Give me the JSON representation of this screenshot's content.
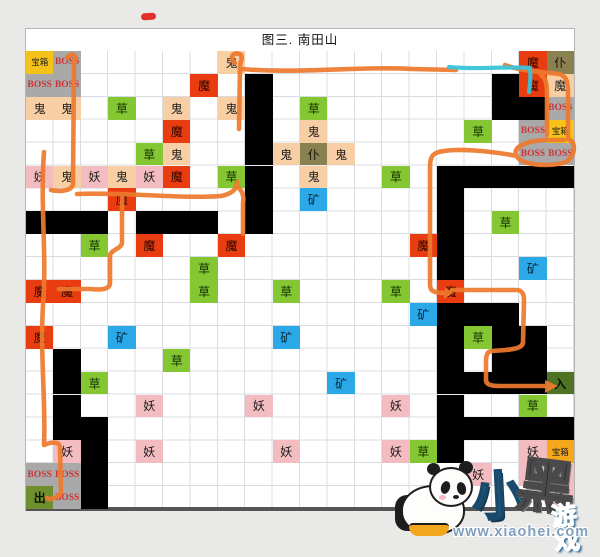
{
  "page": {
    "title": "图三. 南田山"
  },
  "palette": {
    "chest": "#f6c21a",
    "chest2": "#f5a81c",
    "boss": "#a9a9a9",
    "bossText": "#cf3434",
    "ghost": "#f8cfa4",
    "demon": "#f3bcc0",
    "devil": "#e93c10",
    "grass": "#85c733",
    "ore": "#2aa8e8",
    "servant": "#8a8150",
    "exit": "#6f8f2f",
    "entrance": "#4f7324",
    "wall": "#000000",
    "routeOrange": "#ee7a2e",
    "routeCyan": "#3cc3d8",
    "redmark": "#e03027"
  },
  "map": {
    "cols": 20,
    "rows": 20,
    "kind_meanings": {
      "chest": "宝箱 treasure chest",
      "boss": "BOSS",
      "ghost": "鬼 ghost",
      "demon": "妖 demon",
      "devil": "魔 devil",
      "grass": "草 herb",
      "ore": "矿 ore",
      "servant": "仆 servant",
      "exit": "出 exit",
      "entrance": "入 entrance",
      "wall": "black block"
    },
    "cells": [
      {
        "r": 1,
        "c": 1,
        "t": "宝箱",
        "k": "chest"
      },
      {
        "r": 1,
        "c": 2,
        "t": "BOSS",
        "k": "boss"
      },
      {
        "r": 1,
        "c": 8,
        "t": "鬼",
        "k": "ghost"
      },
      {
        "r": 1,
        "c": 19,
        "t": "魔",
        "k": "devil"
      },
      {
        "r": 1,
        "c": 20,
        "t": "仆",
        "k": "servant"
      },
      {
        "r": 2,
        "c": 1,
        "t": "BOSS",
        "k": "boss"
      },
      {
        "r": 2,
        "c": 2,
        "t": "BOSS",
        "k": "boss"
      },
      {
        "r": 2,
        "c": 7,
        "t": "魔",
        "k": "devil"
      },
      {
        "r": 2,
        "c": 19,
        "t": "魔",
        "k": "devil"
      },
      {
        "r": 2,
        "c": 20,
        "t": "魔",
        "k": "ghost"
      },
      {
        "r": 3,
        "c": 1,
        "t": "鬼",
        "k": "ghost"
      },
      {
        "r": 3,
        "c": 2,
        "t": "鬼",
        "k": "ghost"
      },
      {
        "r": 3,
        "c": 4,
        "t": "草",
        "k": "grass"
      },
      {
        "r": 3,
        "c": 6,
        "t": "鬼",
        "k": "ghost"
      },
      {
        "r": 3,
        "c": 8,
        "t": "鬼",
        "k": "ghost"
      },
      {
        "r": 3,
        "c": 11,
        "t": "草",
        "k": "grass"
      },
      {
        "r": 3,
        "c": 20,
        "t": "BOSS",
        "k": "boss"
      },
      {
        "r": 4,
        "c": 6,
        "t": "魔",
        "k": "devil"
      },
      {
        "r": 4,
        "c": 11,
        "t": "鬼",
        "k": "ghost"
      },
      {
        "r": 4,
        "c": 17,
        "t": "草",
        "k": "grass"
      },
      {
        "r": 4,
        "c": 19,
        "t": "BOSS",
        "k": "boss"
      },
      {
        "r": 4,
        "c": 20,
        "t": "宝箱",
        "k": "chest"
      },
      {
        "r": 5,
        "c": 5,
        "t": "草",
        "k": "grass"
      },
      {
        "r": 5,
        "c": 6,
        "t": "鬼",
        "k": "ghost"
      },
      {
        "r": 5,
        "c": 10,
        "t": "鬼",
        "k": "ghost"
      },
      {
        "r": 5,
        "c": 11,
        "t": "仆",
        "k": "servant"
      },
      {
        "r": 5,
        "c": 12,
        "t": "鬼",
        "k": "ghost"
      },
      {
        "r": 5,
        "c": 19,
        "t": "BOSS",
        "k": "boss"
      },
      {
        "r": 5,
        "c": 20,
        "t": "BOSS",
        "k": "boss"
      },
      {
        "r": 6,
        "c": 1,
        "t": "妖",
        "k": "demon"
      },
      {
        "r": 6,
        "c": 2,
        "t": "鬼",
        "k": "ghost"
      },
      {
        "r": 6,
        "c": 3,
        "t": "妖",
        "k": "demon"
      },
      {
        "r": 6,
        "c": 4,
        "t": "鬼",
        "k": "ghost"
      },
      {
        "r": 6,
        "c": 5,
        "t": "妖",
        "k": "demon"
      },
      {
        "r": 6,
        "c": 6,
        "t": "魔",
        "k": "devil"
      },
      {
        "r": 6,
        "c": 8,
        "t": "草",
        "k": "grass"
      },
      {
        "r": 6,
        "c": 11,
        "t": "鬼",
        "k": "ghost"
      },
      {
        "r": 6,
        "c": 14,
        "t": "草",
        "k": "grass"
      },
      {
        "r": 7,
        "c": 4,
        "t": "魔",
        "k": "devil"
      },
      {
        "r": 7,
        "c": 11,
        "t": "矿",
        "k": "ore"
      },
      {
        "r": 8,
        "c": 18,
        "t": "草",
        "k": "grass"
      },
      {
        "r": 9,
        "c": 3,
        "t": "草",
        "k": "grass"
      },
      {
        "r": 9,
        "c": 5,
        "t": "魔",
        "k": "devil"
      },
      {
        "r": 9,
        "c": 8,
        "t": "魔",
        "k": "devil"
      },
      {
        "r": 9,
        "c": 15,
        "t": "魔",
        "k": "devil"
      },
      {
        "r": 10,
        "c": 7,
        "t": "草",
        "k": "grass"
      },
      {
        "r": 10,
        "c": 19,
        "t": "矿",
        "k": "ore"
      },
      {
        "r": 11,
        "c": 1,
        "t": "魔",
        "k": "devil"
      },
      {
        "r": 11,
        "c": 2,
        "t": "魔",
        "k": "devil"
      },
      {
        "r": 11,
        "c": 7,
        "t": "草",
        "k": "grass"
      },
      {
        "r": 11,
        "c": 10,
        "t": "草",
        "k": "grass"
      },
      {
        "r": 11,
        "c": 14,
        "t": "草",
        "k": "grass"
      },
      {
        "r": 11,
        "c": 16,
        "t": "魔",
        "k": "devil"
      },
      {
        "r": 12,
        "c": 15,
        "t": "矿",
        "k": "ore"
      },
      {
        "r": 13,
        "c": 1,
        "t": "魔",
        "k": "devil"
      },
      {
        "r": 13,
        "c": 4,
        "t": "矿",
        "k": "ore"
      },
      {
        "r": 13,
        "c": 10,
        "t": "矿",
        "k": "ore"
      },
      {
        "r": 13,
        "c": 17,
        "t": "草",
        "k": "grass"
      },
      {
        "r": 14,
        "c": 6,
        "t": "草",
        "k": "grass"
      },
      {
        "r": 15,
        "c": 3,
        "t": "草",
        "k": "grass"
      },
      {
        "r": 15,
        "c": 12,
        "t": "矿",
        "k": "ore"
      },
      {
        "r": 15,
        "c": 20,
        "t": "入",
        "k": "entrance"
      },
      {
        "r": 16,
        "c": 5,
        "t": "妖",
        "k": "demon"
      },
      {
        "r": 16,
        "c": 9,
        "t": "妖",
        "k": "demon"
      },
      {
        "r": 16,
        "c": 14,
        "t": "妖",
        "k": "demon"
      },
      {
        "r": 16,
        "c": 19,
        "t": "草",
        "k": "grass"
      },
      {
        "r": 18,
        "c": 2,
        "t": "妖",
        "k": "demon"
      },
      {
        "r": 18,
        "c": 5,
        "t": "妖",
        "k": "demon"
      },
      {
        "r": 18,
        "c": 10,
        "t": "妖",
        "k": "demon"
      },
      {
        "r": 18,
        "c": 14,
        "t": "妖",
        "k": "demon"
      },
      {
        "r": 18,
        "c": 15,
        "t": "草",
        "k": "grass"
      },
      {
        "r": 18,
        "c": 19,
        "t": "妖",
        "k": "demon"
      },
      {
        "r": 18,
        "c": 20,
        "t": "宝箱",
        "k": "chest2"
      },
      {
        "r": 19,
        "c": 1,
        "t": "BOSS",
        "k": "boss"
      },
      {
        "r": 19,
        "c": 2,
        "t": "BOSS",
        "k": "boss"
      },
      {
        "r": 19,
        "c": 17,
        "t": "妖",
        "k": "demon"
      },
      {
        "r": 19,
        "c": 19,
        "t": "妖",
        "k": "demon"
      },
      {
        "r": 19,
        "c": 20,
        "t": "妖",
        "k": "demon"
      },
      {
        "r": 20,
        "c": 1,
        "t": "出",
        "k": "exit"
      },
      {
        "r": 20,
        "c": 2,
        "t": "BOSS",
        "k": "boss"
      },
      {
        "r": 20,
        "c": 20,
        "t": "妖",
        "k": "demon"
      }
    ],
    "walls": [
      [
        2,
        9
      ],
      [
        3,
        9
      ],
      [
        4,
        9
      ],
      [
        5,
        9
      ],
      [
        6,
        9
      ],
      [
        7,
        9
      ],
      [
        8,
        9
      ],
      [
        2,
        18
      ],
      [
        3,
        18
      ],
      [
        3,
        19
      ],
      [
        6,
        16
      ],
      [
        6,
        17
      ],
      [
        6,
        18
      ],
      [
        6,
        19
      ],
      [
        6,
        20
      ],
      [
        7,
        16
      ],
      [
        8,
        16
      ],
      [
        9,
        16
      ],
      [
        10,
        16
      ],
      [
        12,
        16
      ],
      [
        13,
        16
      ],
      [
        14,
        16
      ],
      [
        15,
        16
      ],
      [
        16,
        16
      ],
      [
        17,
        16
      ],
      [
        18,
        16
      ],
      [
        8,
        1
      ],
      [
        8,
        2
      ],
      [
        8,
        3
      ],
      [
        8,
        5
      ],
      [
        8,
        6
      ],
      [
        8,
        7
      ],
      [
        12,
        17
      ],
      [
        12,
        18
      ],
      [
        13,
        18
      ],
      [
        13,
        19
      ],
      [
        14,
        2
      ],
      [
        14,
        18
      ],
      [
        14,
        19
      ],
      [
        15,
        2
      ],
      [
        15,
        17
      ],
      [
        15,
        18
      ],
      [
        15,
        19
      ],
      [
        16,
        2
      ],
      [
        17,
        2
      ],
      [
        17,
        3
      ],
      [
        17,
        17
      ],
      [
        17,
        18
      ],
      [
        17,
        19
      ],
      [
        17,
        20
      ],
      [
        18,
        3
      ],
      [
        19,
        3
      ],
      [
        20,
        3
      ]
    ]
  },
  "annotations": {
    "hand_drawn_red_mark": "二",
    "route_note": "hand-drawn orange walkthrough route from 入 (entrance) to 出 (exit), short cyan segment at top right"
  },
  "watermark": {
    "brand_char_1": "小",
    "brand_char_2": "黑",
    "brand_suffix": "游戏",
    "url": "www.xiaohei.com"
  }
}
